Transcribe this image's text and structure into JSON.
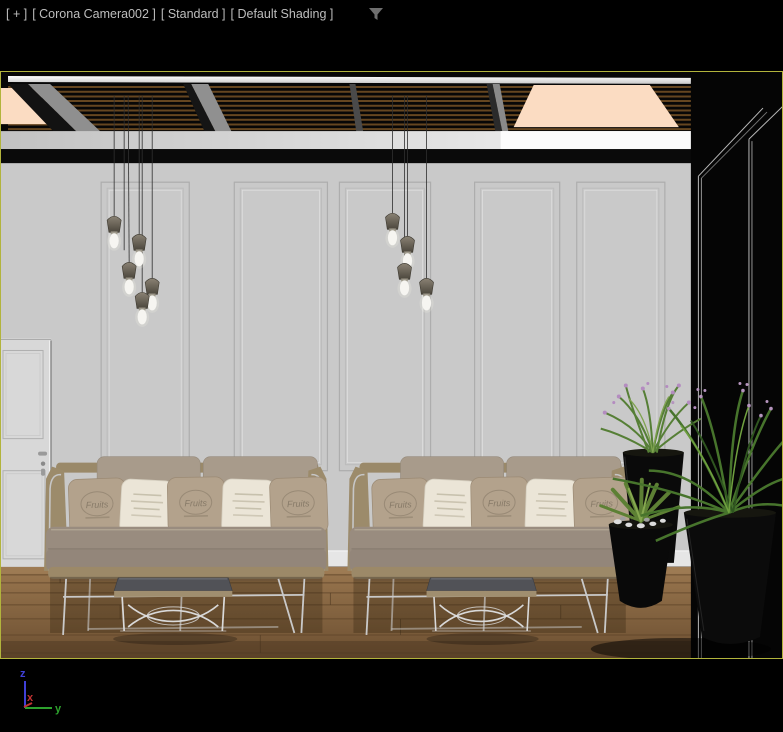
{
  "viewport": {
    "label_general": "[ + ]",
    "label_camera": "[ Corona Camera002 ]",
    "label_render_preset": "[ Standard ]",
    "label_shading": "[ Default Shading ]"
  },
  "icons": {
    "viewport_filter": "funnel"
  },
  "axis_gizmo": {
    "x_label": "x",
    "y_label": "y",
    "z_label": "z"
  },
  "scene": {
    "pillow_print_text": "Fruits"
  },
  "colors": {
    "viewport_border": "#b2b43c",
    "label_text": "#bdbdbd",
    "wall": "#c9c9c9",
    "wall_panel_line": "#adadad",
    "ceiling": "#070707",
    "ceiling_slat": "#6b4a22",
    "ceiling_light": "#fbdcc2",
    "beam": "#8f8f8f",
    "floor": "#8a6a47",
    "baseboard": "#e6e6e6",
    "sofa_frame": "#9c8b6b",
    "sofa_cushion": "#998c7f",
    "pillow_taupe": "#b3a28c",
    "pillow_white": "#ebe5d7",
    "table_top": "#515257",
    "metal_tube": "#c9c9c9",
    "pot": "#0b0b0b",
    "foliage": "#4d7733",
    "flower": "#b48cc0",
    "lamp_shade": "#6f6a5c",
    "lamp_bulb": "#f6f5f1",
    "axis_x": "#c03232",
    "axis_y": "#2da12d",
    "axis_z": "#4040d8"
  }
}
